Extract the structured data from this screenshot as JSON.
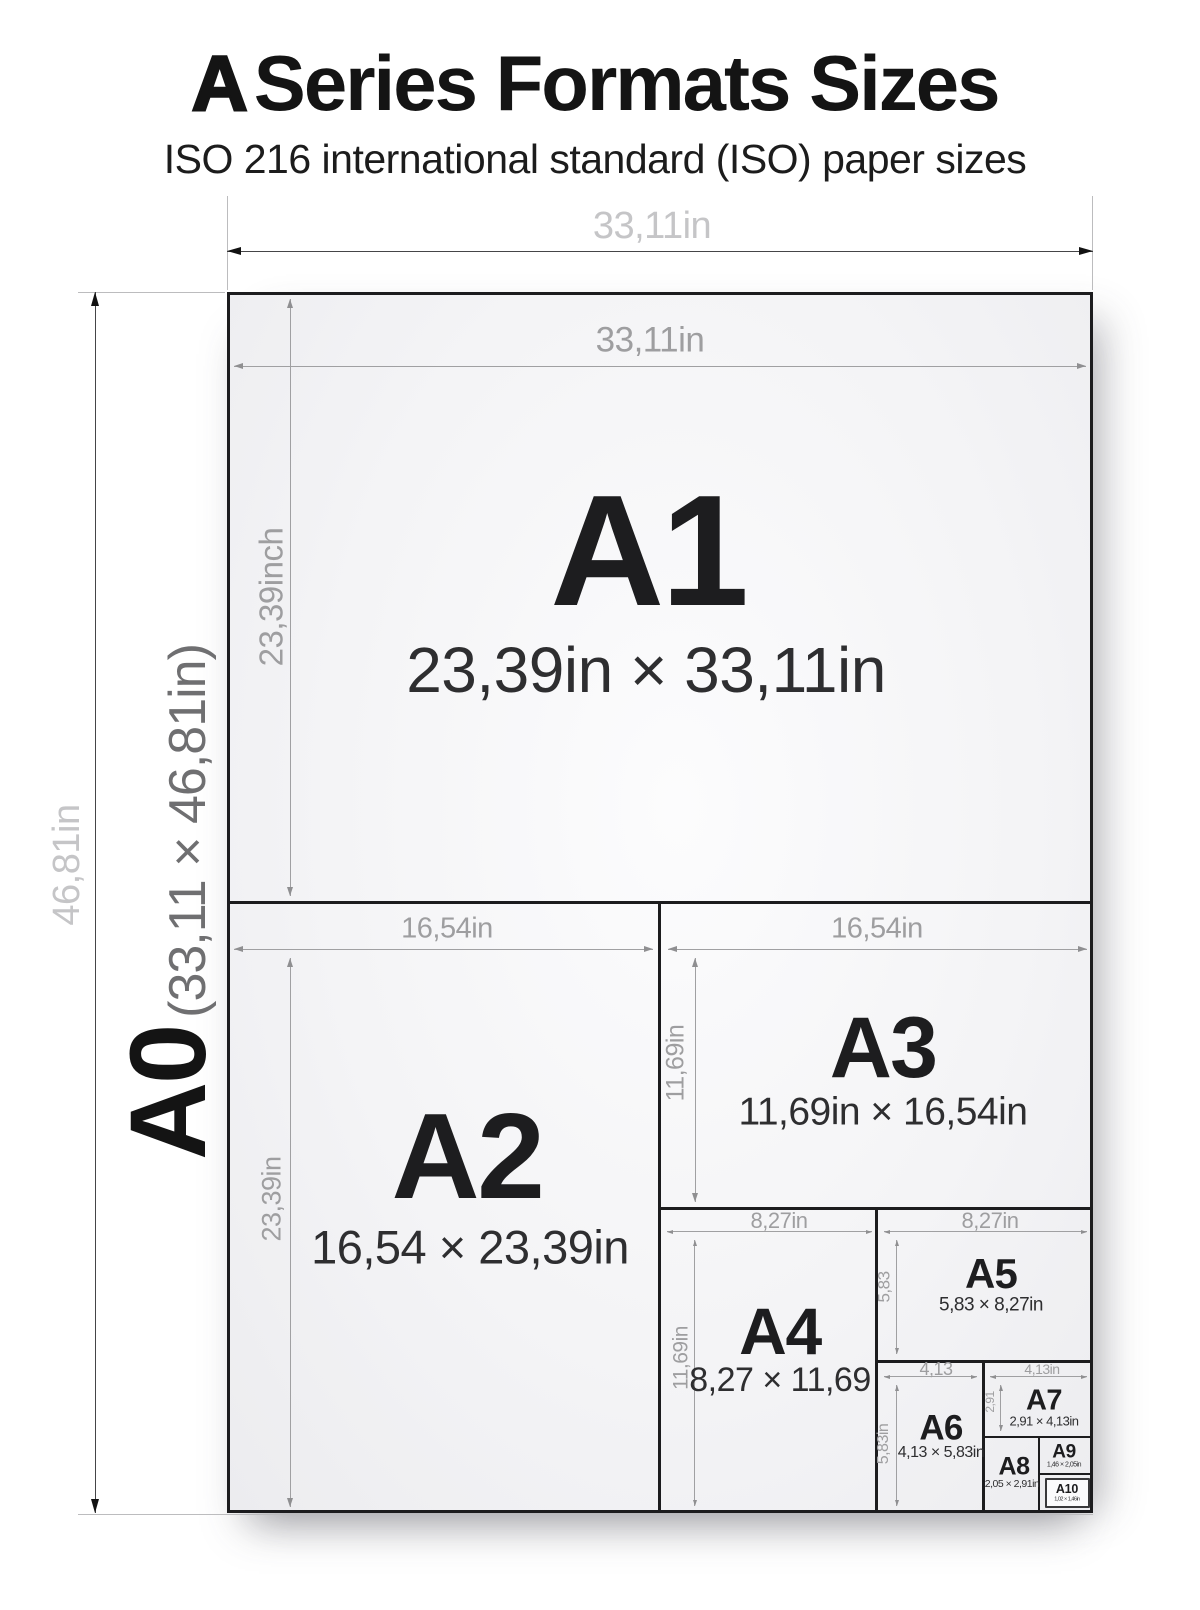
{
  "title": {
    "bold_letter": "A",
    "text": "Series Formats Sizes",
    "subtitle": "ISO 216 international standard (ISO) paper sizes"
  },
  "a0": {
    "label": "A0",
    "dims": "(33,11 × 46,81in)",
    "width_dim": "33,11in",
    "height_dim": "46,81in"
  },
  "formats": {
    "a1": {
      "label": "A1",
      "dims": "23,39in × 33,11in",
      "width_dim": "33,11in",
      "height_dim": "23,39inch"
    },
    "a2": {
      "label": "A2",
      "dims": "16,54 × 23,39in",
      "width_dim": "16,54in",
      "height_dim": "23,39in"
    },
    "a3": {
      "label": "A3",
      "dims": "11,69in × 16,54in",
      "width_dim": "16,54in",
      "height_dim": "11,69in"
    },
    "a4": {
      "label": "A4",
      "dims": "8,27 × 11,69",
      "width_dim": "8,27in",
      "height_dim": "11,69in"
    },
    "a5": {
      "label": "A5",
      "dims": "5,83 × 8,27in",
      "width_dim": "8,27in",
      "height_dim": "5,83"
    },
    "a6": {
      "label": "A6",
      "dims": "4,13 × 5,83in",
      "width_dim": "4,13",
      "height_dim": "5,83in"
    },
    "a7": {
      "label": "A7",
      "dims": "2,91 × 4,13in",
      "width_dim": "4,13in",
      "height_dim": "2,91"
    },
    "a8": {
      "label": "A8",
      "dims": "2,05 × 2,91in"
    },
    "a9": {
      "label": "A9",
      "dims": "1,46 × 2,05in"
    },
    "a10": {
      "label": "A10",
      "dims": "1,02 × 1,46in"
    }
  },
  "colors": {
    "line_dark": "#1c1c1e",
    "dim_line_gray": "#a0a0a2",
    "dim_label_gray": "#9e9ea0",
    "outer_dim_label_gray": "#c5c5c7",
    "text_dark": "#1d1d1f"
  }
}
